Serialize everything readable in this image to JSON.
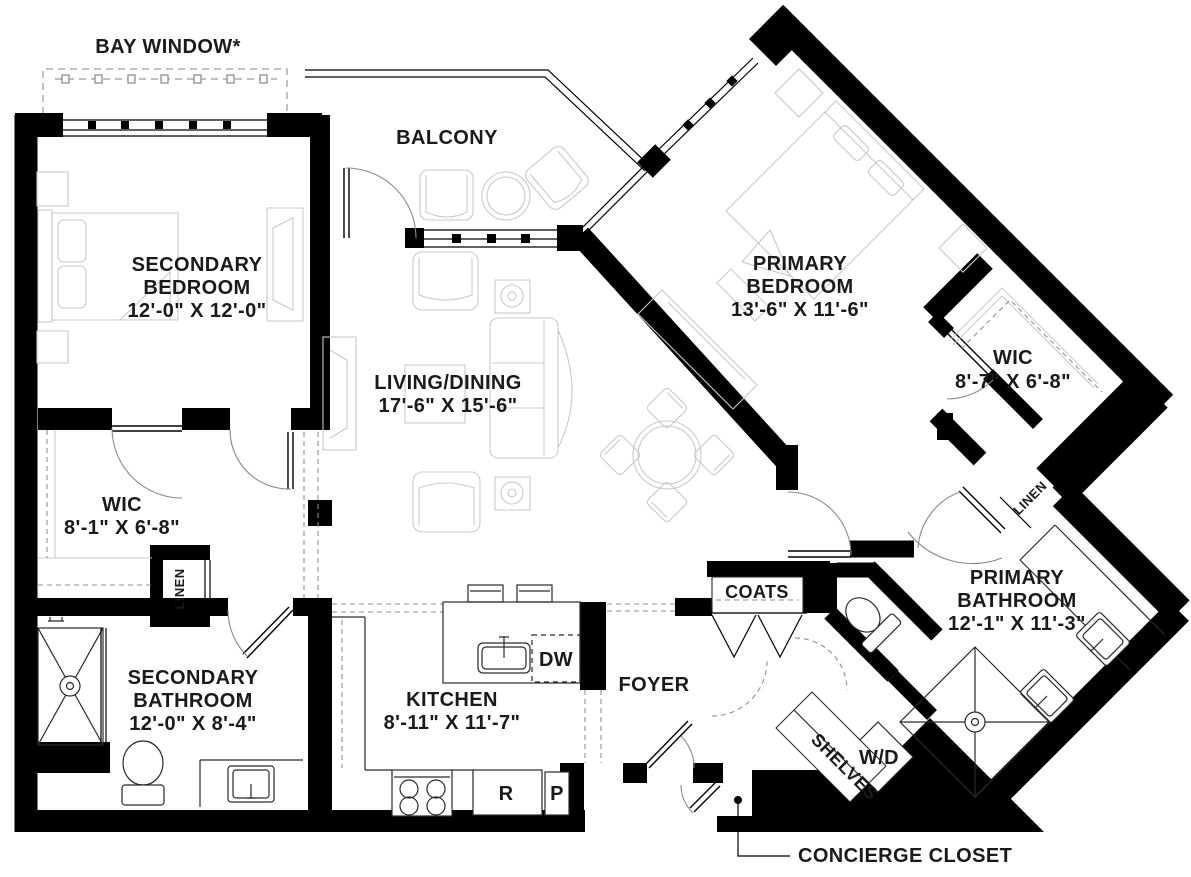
{
  "annotations": {
    "bay_window": "BAY WINDOW*",
    "balcony": "BALCONY",
    "concierge_closet": "CONCIERGE CLOSET"
  },
  "rooms": {
    "secondary_bedroom": {
      "line1": "SECONDARY",
      "line2": "BEDROOM",
      "dims": "12'-0\" X 12'-0\""
    },
    "primary_bedroom": {
      "line1": "PRIMARY",
      "line2": "BEDROOM",
      "dims": "13'-6\" X 11'-6\""
    },
    "living_dining": {
      "line1": "LIVING/DINING",
      "dims": "17'-6\" X 15'-6\""
    },
    "kitchen": {
      "line1": "KITCHEN",
      "dims": "8'-11\" X 11'-7\""
    },
    "foyer": {
      "line1": "FOYER"
    },
    "primary_bathroom": {
      "line1": "PRIMARY",
      "line2": "BATHROOM",
      "dims": "12'-1\" X 11'-3\""
    },
    "secondary_bathroom": {
      "line1": "SECONDARY",
      "line2": "BATHROOM",
      "dims": "12'-0\" X 8'-4\""
    },
    "wic_left": {
      "line1": "WIC",
      "dims": "8'-1\" X 6'-8\""
    },
    "wic_right": {
      "line1": "WIC",
      "dims": "8'-7\" X 6'-8\""
    }
  },
  "closets": {
    "linen_left": "LINEN",
    "linen_right": "LINEN",
    "coats": "COATS",
    "shelves": "SHELVES"
  },
  "appliances": {
    "dishwasher": "DW",
    "refrigerator": "R",
    "pantry": "P",
    "washer_dryer": "W/D"
  },
  "colors": {
    "wall": "#000000",
    "furniture_line": "#c9c9c9",
    "text": "#1a1a1a",
    "background": "#ffffff"
  }
}
